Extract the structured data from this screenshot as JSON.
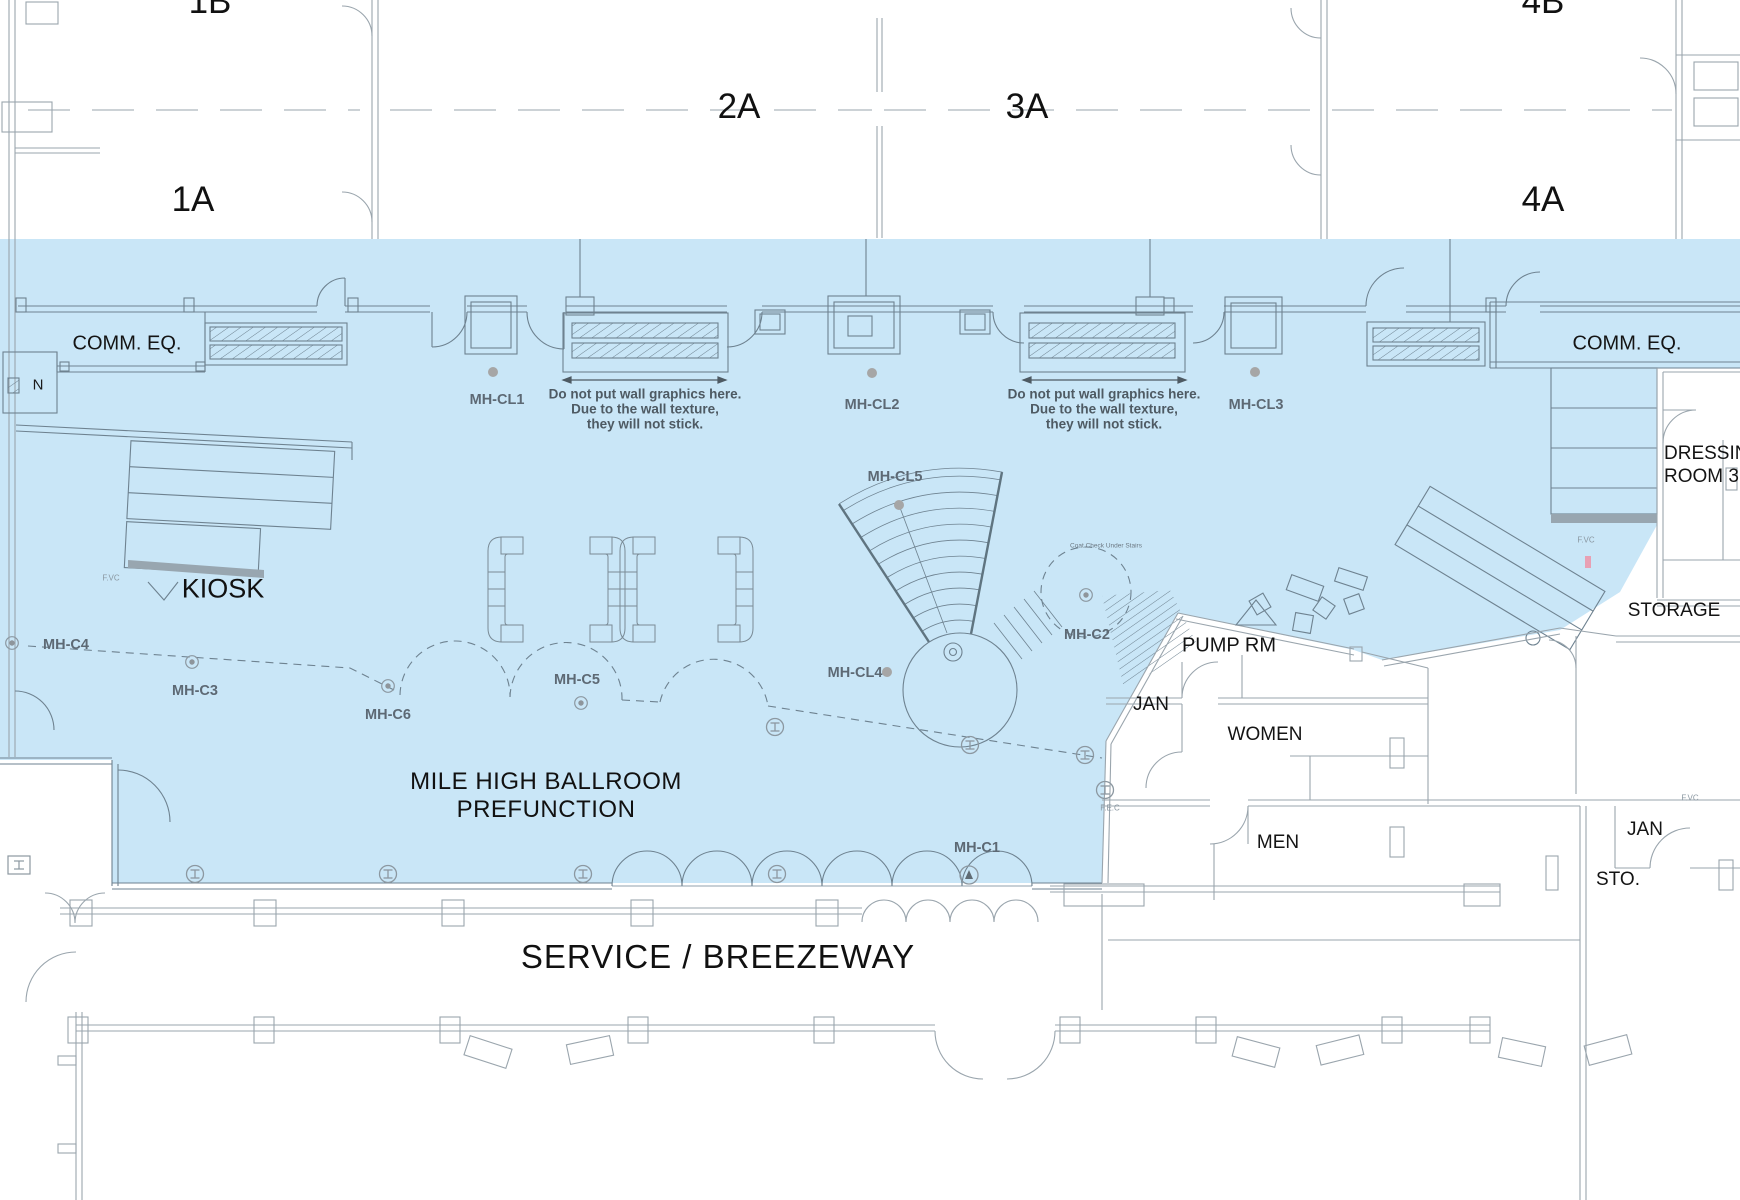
{
  "palette": {
    "highlight": "#c9e6f7",
    "wall_blue_zone": "#6e8290",
    "wall_white_zone": "#9aa5ad",
    "text_dark": "#111111",
    "text_marker_gray": "#5d6974",
    "marker_dot": "#a6a6a6",
    "stair_tint": "#98a6b0"
  },
  "plan": {
    "halls": {
      "h1b": "1B",
      "h1a": "1A",
      "h2a": "2A",
      "h3a": "3A",
      "h4b": "4B",
      "h4a": "4A"
    },
    "rooms": {
      "comm_eq": "COMM. EQ.",
      "kiosk": "KIOSK",
      "dressing_line1": "DRESSING",
      "dressing_line2": "ROOM 3",
      "storage": "STORAGE",
      "pump_rm": "PUMP RM",
      "jan": "JAN",
      "women": "WOMEN",
      "men": "MEN",
      "sto": "STO.",
      "prefunction_line1": "MILE HIGH BALLROOM",
      "prefunction_line2": "PREFUNCTION",
      "service": "SERVICE / BREEZEWAY"
    },
    "compass": "N",
    "notes": {
      "wall_graphics_1": "Do not put wall graphics here.",
      "wall_graphics_2": "Due to the wall texture,",
      "wall_graphics_3": "they will not stick.",
      "coat_check": "Coat Check Under Stairs"
    },
    "camera_labels": {
      "mh_cl1": "MH-CL1",
      "mh_cl2": "MH-CL2",
      "mh_cl3": "MH-CL3",
      "mh_cl4": "MH-CL4",
      "mh_cl5": "MH-CL5",
      "mh_c1": "MH-C1",
      "mh_c2": "MH-C2",
      "mh_c3": "MH-C3",
      "mh_c4": "MH-C4",
      "mh_c5": "MH-C5",
      "mh_c6": "MH-C6"
    },
    "safety_labels": {
      "fvc": "F.VC",
      "fec": "F.E.C"
    }
  }
}
